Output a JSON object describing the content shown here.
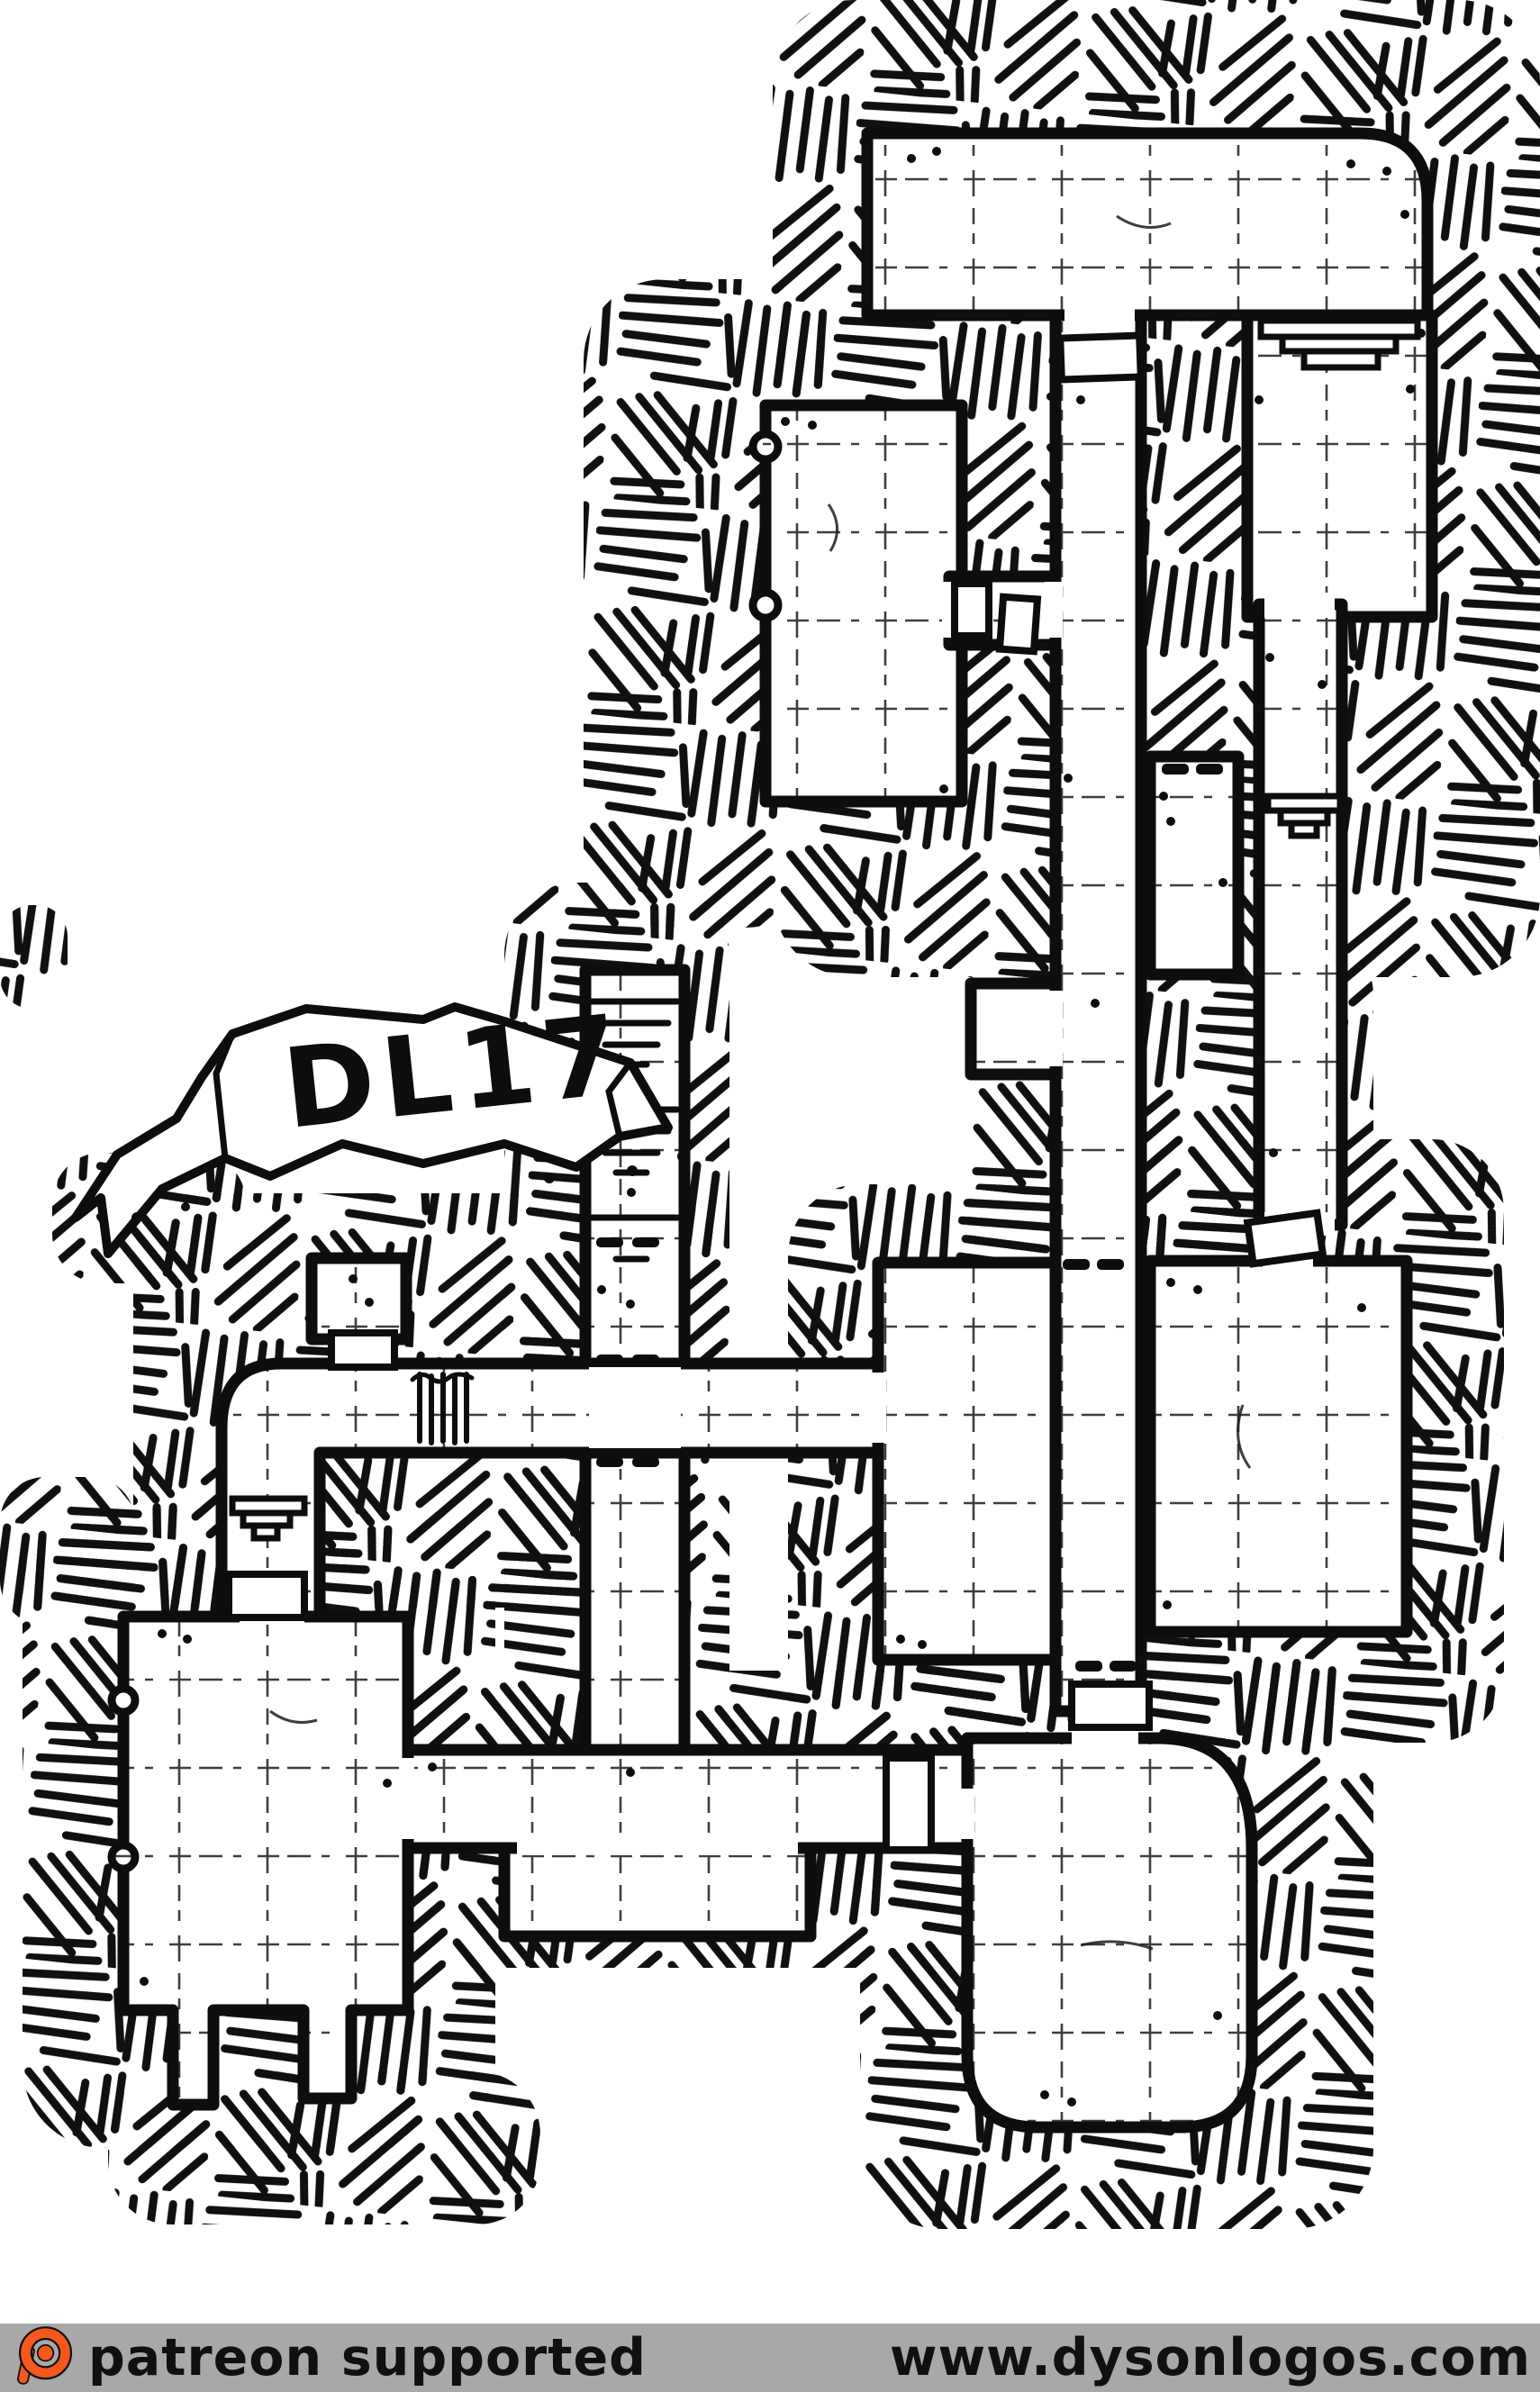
{
  "banner": {
    "label": "DL17"
  },
  "map": {
    "style": "hand-drawn-dungeon-map",
    "ink_color": "#0d0d0d",
    "paper_color": "#ffffff",
    "features": [
      "crosshatched rock fill",
      "gridded room floors",
      "doors",
      "secret-door dashes",
      "stairs descending",
      "stepped altars",
      "portcullis bars",
      "rounded south-east chamber",
      "ribbon banner label"
    ]
  },
  "footer": {
    "left_text": "patreon supported",
    "right_text": "www.dysonlogos.com",
    "bar_color": "#a8a8a8",
    "text_color": "#101010",
    "logo_color": "#f4581c",
    "logo_icon": "patreon-icon"
  }
}
